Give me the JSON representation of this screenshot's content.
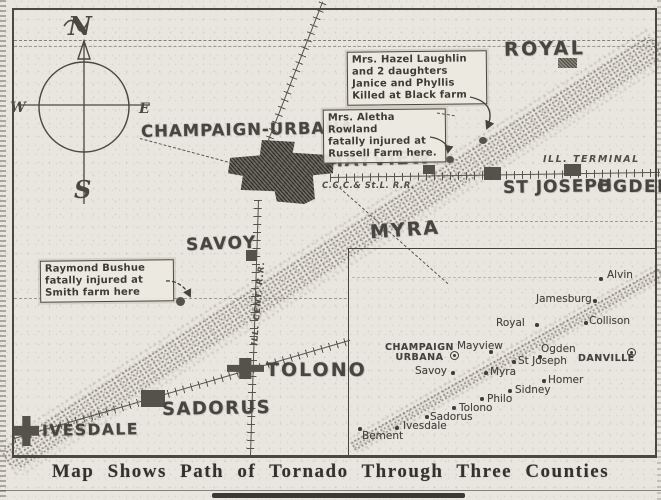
{
  "caption": {
    "text": "Map Shows Path of Tornado Through Three Counties"
  },
  "compass": {
    "north": "N",
    "south": "S",
    "east": "E",
    "west": "W"
  },
  "colors": {
    "paper": "#e9e6df",
    "ink": "#44423c",
    "band_stipple": "#8a857b",
    "marker": "#55524a"
  },
  "main_map": {
    "towns": [
      {
        "name": "ROYAL",
        "x": 504,
        "y": 38,
        "fs": 19,
        "ls": 2.5,
        "r": -1
      },
      {
        "name": "CHAMPAIGN-URBANA",
        "x": 141,
        "y": 120,
        "fs": 16.5,
        "ls": 1,
        "r": -1
      },
      {
        "name": "MAYVIEW",
        "x": 325,
        "y": 149,
        "fs": 18,
        "ls": 1.5,
        "r": -2
      },
      {
        "name": "ST JOSEPH",
        "x": 503,
        "y": 177,
        "fs": 17,
        "ls": 1,
        "r": -1
      },
      {
        "name": "OGDEN",
        "x": 597,
        "y": 177,
        "fs": 17,
        "ls": 1.5,
        "r": 0
      },
      {
        "name": "MYRA",
        "x": 370,
        "y": 219,
        "fs": 19,
        "ls": 2,
        "r": -4
      },
      {
        "name": "SAVOY",
        "x": 186,
        "y": 234,
        "fs": 17,
        "ls": 1.5,
        "r": -2
      },
      {
        "name": "TOLONO",
        "x": 266,
        "y": 359,
        "fs": 19,
        "ls": 2,
        "r": 0
      },
      {
        "name": "SADORUS",
        "x": 162,
        "y": 398,
        "fs": 18,
        "ls": 1.5,
        "r": -1
      },
      {
        "name": "IVESDALE",
        "x": 42,
        "y": 421,
        "fs": 15.5,
        "ls": 1.5,
        "r": -1
      }
    ],
    "markers": [
      {
        "id": "royal",
        "x": 558,
        "y": 58,
        "w": 19,
        "h": 10,
        "shape": "hatch"
      },
      {
        "id": "mayview",
        "x": 423,
        "y": 165,
        "w": 12,
        "h": 9,
        "shape": "rect"
      },
      {
        "id": "st-joseph",
        "x": 484,
        "y": 167,
        "w": 17,
        "h": 13,
        "shape": "rect"
      },
      {
        "id": "ogden",
        "x": 564,
        "y": 164,
        "w": 17,
        "h": 12,
        "shape": "rect"
      },
      {
        "id": "savoy",
        "x": 246,
        "y": 250,
        "w": 11,
        "h": 11,
        "shape": "rect"
      },
      {
        "id": "tolono",
        "x": 227,
        "y": 358,
        "w": 37,
        "h": 21,
        "shape": "cross"
      },
      {
        "id": "sadorus",
        "x": 141,
        "y": 390,
        "w": 24,
        "h": 17,
        "shape": "rect"
      },
      {
        "id": "ivesdale",
        "x": 14,
        "y": 416,
        "w": 25,
        "h": 30,
        "shape": "cross"
      },
      {
        "id": "smith-farm",
        "x": 176,
        "y": 297,
        "w": 9,
        "h": 9,
        "shape": "dot"
      },
      {
        "id": "russell-farm",
        "x": 446,
        "y": 156,
        "w": 8,
        "h": 7,
        "shape": "dot"
      },
      {
        "id": "black-farm",
        "x": 479,
        "y": 137,
        "w": 8,
        "h": 7,
        "shape": "dot"
      }
    ],
    "railroad_labels": [
      {
        "id": "ill-terminal",
        "text": "ILL. TERMINAL"
      },
      {
        "id": "big-four",
        "text": "C.C.C.& St.L. R.R."
      },
      {
        "id": "illinois-central",
        "text": "ILL. CENT. R.R."
      }
    ],
    "annotations": [
      {
        "id": "hazel-laughlin",
        "lines": [
          "Mrs. Hazel Laughlin",
          "and 2 daughters",
          "Janice and Phyllis",
          "Killed at Black farm"
        ]
      },
      {
        "id": "aletha-rowland",
        "lines": [
          "Mrs. Aletha Rowland",
          "fatally injured at",
          "Russell Farm here."
        ]
      },
      {
        "id": "raymond-bushue",
        "lines": [
          "Raymond Bushue",
          "fatally injured at",
          "Smith farm here"
        ]
      }
    ]
  },
  "inset_map": {
    "towns": [
      {
        "name": "Alvin",
        "lx": 607,
        "ly": 269,
        "dx": 599,
        "dy": 277,
        "type": "dot"
      },
      {
        "name": "Jamesburg",
        "lx": 536,
        "ly": 293,
        "dx": 593,
        "dy": 299,
        "type": "dot"
      },
      {
        "name": "Royal",
        "lx": 496,
        "ly": 317,
        "dx": 535,
        "dy": 323,
        "type": "dot"
      },
      {
        "name": "Collison",
        "lx": 589,
        "ly": 315,
        "dx": 584,
        "dy": 321,
        "type": "dot"
      },
      {
        "name": "CHAMPAIGN\nURBANA",
        "lx": 385,
        "ly": 343,
        "dx": 450,
        "dy": 351,
        "type": "circle",
        "caps": true
      },
      {
        "name": "Mayview",
        "lx": 457,
        "ly": 340,
        "dx": 489,
        "dy": 350,
        "type": "dot"
      },
      {
        "name": "Ogden",
        "lx": 541,
        "ly": 343,
        "dx": 538,
        "dy": 355,
        "type": "dot"
      },
      {
        "name": "DANVILLE",
        "lx": 578,
        "ly": 354,
        "dx": 627,
        "dy": 348,
        "type": "circle",
        "caps": true
      },
      {
        "name": "St Joseph",
        "lx": 518,
        "ly": 355,
        "dx": 512,
        "dy": 360,
        "type": "dot"
      },
      {
        "name": "Savoy",
        "lx": 415,
        "ly": 365,
        "dx": 451,
        "dy": 371,
        "type": "dot"
      },
      {
        "name": "Myra",
        "lx": 490,
        "ly": 366,
        "dx": 484,
        "dy": 371,
        "type": "dot"
      },
      {
        "name": "Homer",
        "lx": 548,
        "ly": 374,
        "dx": 542,
        "dy": 379,
        "type": "dot"
      },
      {
        "name": "Sidney",
        "lx": 515,
        "ly": 384,
        "dx": 508,
        "dy": 389,
        "type": "dot"
      },
      {
        "name": "Philo",
        "lx": 487,
        "ly": 393,
        "dx": 480,
        "dy": 397,
        "type": "dot"
      },
      {
        "name": "Tolono",
        "lx": 459,
        "ly": 402,
        "dx": 452,
        "dy": 406,
        "type": "dot"
      },
      {
        "name": "Sadorus",
        "lx": 430,
        "ly": 411,
        "dx": 425,
        "dy": 415,
        "type": "dot"
      },
      {
        "name": "Ivesdale",
        "lx": 403,
        "ly": 420,
        "dx": 395,
        "dy": 426,
        "type": "dot"
      },
      {
        "name": "Bement",
        "lx": 362,
        "ly": 430,
        "dx": 358,
        "dy": 427,
        "type": "dot"
      }
    ]
  }
}
